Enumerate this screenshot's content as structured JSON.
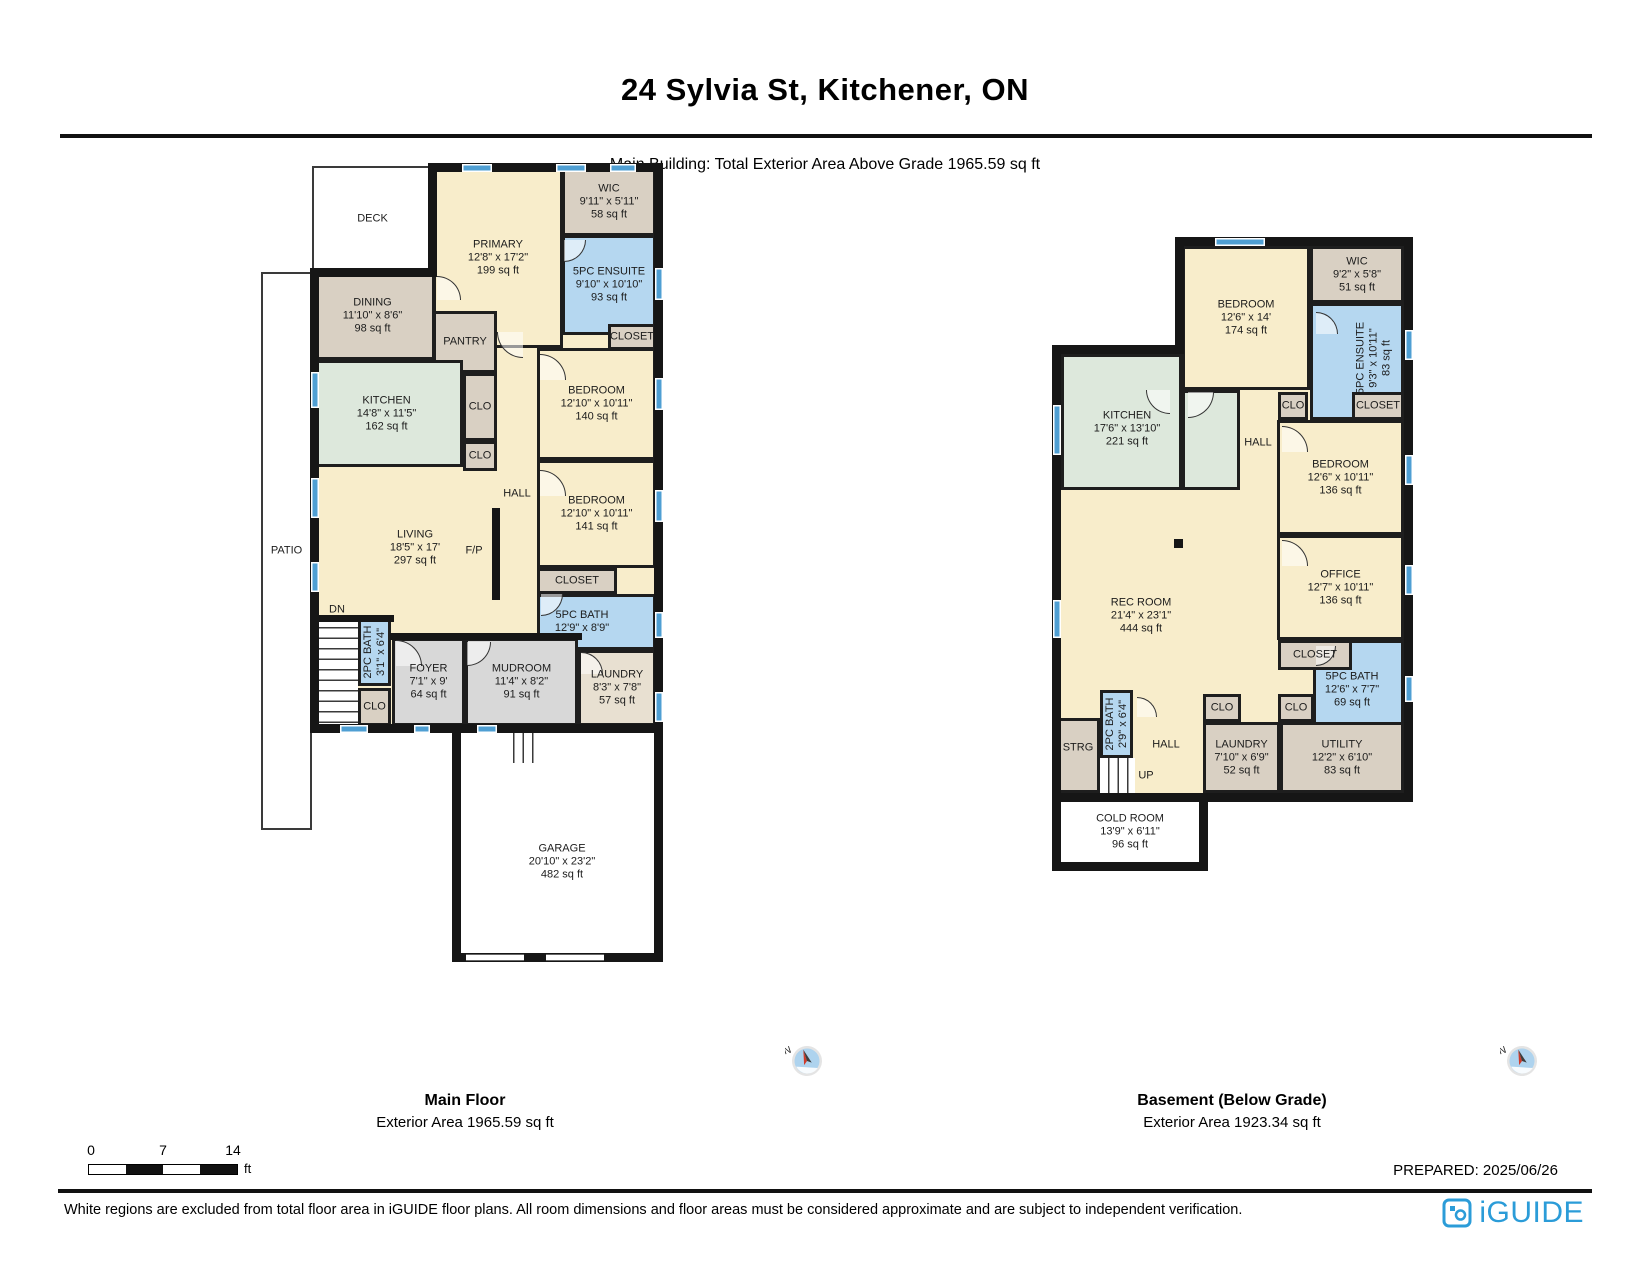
{
  "header": {
    "title": "24 Sylvia St, Kitchener, ON",
    "subtitle": "Main Building: Total Exterior Area Above Grade 1965.59 sq ft"
  },
  "compass": {
    "label": "N"
  },
  "scale_bar": {
    "ticks": [
      "0",
      "7",
      "14"
    ],
    "unit": "ft"
  },
  "footer": {
    "prepared": "PREPARED: 2025/06/26",
    "disclaimer": "White regions are excluded from total floor area in iGUIDE floor plans. All room dimensions and floor areas must be considered approximate and are subject to independent verification.",
    "brand": "iGUIDE"
  },
  "colors": {
    "room_cream": "#f8edcb",
    "room_tan": "#d9d0c3",
    "room_tan_light": "#e8e0d1",
    "room_blue": "#b5d7f0",
    "room_green": "#dde8dc",
    "room_gray": "#d8d8d8",
    "wall": "#161616",
    "window_blue": "#4f9fd3",
    "brand_blue": "#2b9cd8"
  },
  "floors": [
    {
      "id": "main",
      "name": "Main Floor",
      "area_label": "Exterior Area 1965.59 sq ft",
      "bg": [
        [
          314,
          168,
          345,
          560
        ]
      ],
      "rooms": [
        {
          "id": "deck",
          "rect": [
            312,
            166,
            121,
            105
          ],
          "fill": "white",
          "thin": true,
          "lines": [
            "DECK"
          ]
        },
        {
          "id": "patio",
          "rect": [
            261,
            272,
            51,
            558
          ],
          "fill": "white",
          "thin": true,
          "lines": [
            "PATIO"
          ]
        },
        {
          "id": "primary-bedroom",
          "rect": [
            433,
            168,
            130,
            180
          ],
          "fill": "cream",
          "lines": [
            "PRIMARY",
            "12'8\" x 17'2\"",
            "199 sq ft"
          ]
        },
        {
          "id": "wic",
          "rect": [
            562,
            168,
            94,
            68
          ],
          "fill": "tan",
          "lines": [
            "WIC",
            "9'11\" x 5'11\"",
            "58 sq ft"
          ]
        },
        {
          "id": "ensuite-5pc",
          "rect": [
            562,
            235,
            94,
            100
          ],
          "fill": "blue",
          "lines": [
            "5PC ENSUITE",
            "9'10\" x 10'10\"",
            "93 sq ft"
          ]
        },
        {
          "id": "closet-ensuite",
          "rect": [
            608,
            324,
            48,
            26
          ],
          "fill": "tan",
          "lines": [
            "CLOSET"
          ]
        },
        {
          "id": "dining",
          "rect": [
            310,
            271,
            125,
            89
          ],
          "fill": "tan",
          "lines": [
            "DINING",
            "11'10\" x 8'6\"",
            "98 sq ft"
          ]
        },
        {
          "id": "pantry",
          "rect": [
            433,
            311,
            64,
            62
          ],
          "fill": "tan",
          "lines": [
            "PANTRY"
          ]
        },
        {
          "id": "kitchen",
          "rect": [
            310,
            360,
            153,
            107
          ],
          "fill": "green",
          "lines": [
            "KITCHEN",
            "14'8\" x 11'5\"",
            "162 sq ft"
          ]
        },
        {
          "id": "closet-hall-a",
          "rect": [
            463,
            373,
            34,
            68
          ],
          "fill": "tan",
          "lines": [
            "CLO"
          ]
        },
        {
          "id": "closet-hall-b",
          "rect": [
            463,
            441,
            34,
            30
          ],
          "fill": "tan",
          "lines": [
            "CLO"
          ]
        },
        {
          "id": "bedroom-1",
          "rect": [
            537,
            348,
            119,
            112
          ],
          "fill": "cream",
          "lines": [
            "BEDROOM",
            "12'10\" x 10'11\"",
            "140 sq ft"
          ]
        },
        {
          "id": "bedroom-2",
          "rect": [
            537,
            460,
            119,
            108
          ],
          "fill": "cream",
          "lines": [
            "BEDROOM",
            "12'10\" x 10'11\"",
            "141 sq ft"
          ]
        },
        {
          "id": "closet-bedroom2",
          "rect": [
            537,
            568,
            80,
            26
          ],
          "fill": "tan",
          "lines": [
            "CLOSET"
          ]
        },
        {
          "id": "bath-5pc",
          "rect": [
            537,
            594,
            119,
            56
          ],
          "fill": "blue",
          "lx": 582,
          "lines": [
            "5PC BATH",
            "12'9\" x 8'9\""
          ]
        },
        {
          "id": "living",
          "lx": 415,
          "ly": 548,
          "lines": [
            "LIVING",
            "18'5\" x 17'",
            "297 sq ft"
          ]
        },
        {
          "id": "hall",
          "lx": 517,
          "ly": 494,
          "lines": [
            "HALL"
          ]
        },
        {
          "id": "fireplace-label",
          "lx": 474,
          "ly": 551,
          "lines": [
            "F/P"
          ]
        },
        {
          "id": "dn-label",
          "lx": 337,
          "ly": 610,
          "lines": [
            "DN"
          ]
        },
        {
          "id": "stairs-down",
          "rect": [
            312,
            618,
            46,
            107
          ],
          "fill": "white",
          "stairs": "h"
        },
        {
          "id": "bath-2pc",
          "rect": [
            358,
            618,
            33,
            68
          ],
          "fill": "blue",
          "vert": true,
          "lines": [
            "2PC BATH",
            "3'1\" x 6'4\""
          ]
        },
        {
          "id": "closet-foyer",
          "rect": [
            358,
            688,
            33,
            38
          ],
          "fill": "tan",
          "lines": [
            "CLO"
          ]
        },
        {
          "id": "foyer",
          "rect": [
            392,
            638,
            73,
            88
          ],
          "fill": "gray",
          "lines": [
            "FOYER",
            "7'1\" x 9'",
            "64 sq ft"
          ]
        },
        {
          "id": "mudroom",
          "rect": [
            465,
            638,
            113,
            88
          ],
          "fill": "gray",
          "lines": [
            "MUDROOM",
            "11'4\" x 8'2\"",
            "91 sq ft"
          ]
        },
        {
          "id": "laundry",
          "rect": [
            578,
            650,
            78,
            76
          ],
          "fill": "tan2",
          "lines": [
            "LAUNDRY",
            "8'3\" x 7'8\"",
            "57 sq ft"
          ]
        },
        {
          "id": "garage",
          "rect": [
            457,
            738,
            201,
            219
          ],
          "fill": "white",
          "nb": true,
          "lx": 562,
          "ly": 862,
          "lines": [
            "GARAGE",
            "20'10\" x 23'2\"",
            "482 sq ft"
          ]
        },
        {
          "id": "stairs-garage",
          "rect": [
            505,
            733,
            34,
            30
          ],
          "fill": "white",
          "stairs": "v"
        }
      ],
      "walls": [
        [
          430,
          163,
          233,
          9
        ],
        [
          654,
          163,
          9,
          570
        ],
        [
          310,
          724,
          353,
          9
        ],
        [
          310,
          268,
          9,
          465
        ],
        [
          310,
          268,
          125,
          9
        ],
        [
          428,
          163,
          9,
          114
        ],
        [
          452,
          733,
          9,
          229
        ],
        [
          654,
          733,
          9,
          229
        ],
        [
          452,
          953,
          211,
          9
        ],
        [
          310,
          615,
          84,
          7
        ],
        [
          390,
          633,
          192,
          7
        ],
        [
          492,
          508,
          8,
          92
        ]
      ],
      "windows": [
        [
          462,
          164,
          30,
          8
        ],
        [
          556,
          164,
          30,
          8
        ],
        [
          610,
          164,
          26,
          8
        ],
        [
          655,
          268,
          8,
          32
        ],
        [
          655,
          378,
          8,
          32
        ],
        [
          655,
          490,
          8,
          32
        ],
        [
          655,
          612,
          8,
          26
        ],
        [
          655,
          692,
          8,
          30
        ],
        [
          311,
          372,
          8,
          36
        ],
        [
          311,
          478,
          8,
          40
        ],
        [
          311,
          562,
          8,
          30
        ],
        [
          340,
          725,
          28,
          8
        ],
        [
          414,
          725,
          16,
          8
        ],
        [
          477,
          725,
          20,
          8
        ]
      ],
      "openings": [
        [
          466,
          954,
          58,
          7
        ],
        [
          546,
          954,
          58,
          7
        ]
      ],
      "doors": [
        [
          497,
          332,
          26,
          180
        ],
        [
          540,
          354,
          26,
          0
        ],
        [
          540,
          470,
          26,
          0
        ],
        [
          541,
          594,
          22,
          90
        ],
        [
          396,
          640,
          26,
          0
        ],
        [
          467,
          642,
          24,
          90
        ],
        [
          581,
          652,
          22,
          0
        ],
        [
          437,
          276,
          24,
          0
        ],
        [
          564,
          240,
          22,
          90
        ]
      ]
    },
    {
      "id": "basement",
      "name": "Basement (Below Grade)",
      "area_label": "Exterior Area 1923.34 sq ft",
      "bg": [
        [
          1182,
          245,
          222,
          552
        ],
        [
          1056,
          352,
          126,
          445
        ]
      ],
      "rooms": [
        {
          "id": "bedroom-basement-1",
          "rect": [
            1182,
            246,
            128,
            144
          ],
          "fill": "cream",
          "lines": [
            "BEDROOM",
            "12'6\" x 14'",
            "174 sq ft"
          ]
        },
        {
          "id": "wic-basement",
          "rect": [
            1310,
            246,
            94,
            57
          ],
          "fill": "tan",
          "lines": [
            "WIC",
            "9'2\" x 5'8\"",
            "51 sq ft"
          ]
        },
        {
          "id": "ensuite-basement",
          "rect": [
            1310,
            303,
            94,
            117
          ],
          "fill": "blue",
          "vert": true,
          "lx": 1374,
          "ly": 358,
          "lines": [
            "5PC ENSUITE",
            "9'3\" x 10'11\"",
            "83 sq ft"
          ]
        },
        {
          "id": "closet-hall-basement",
          "rect": [
            1278,
            392,
            30,
            28
          ],
          "fill": "tan",
          "lines": [
            "CLO"
          ]
        },
        {
          "id": "closet-upper-basement",
          "rect": [
            1352,
            392,
            52,
            28
          ],
          "fill": "tan",
          "lines": [
            "CLOSET"
          ]
        },
        {
          "id": "bedroom-basement-2",
          "rect": [
            1277,
            420,
            127,
            115
          ],
          "fill": "cream",
          "lines": [
            "BEDROOM",
            "12'6\" x 10'11\"",
            "136 sq ft"
          ]
        },
        {
          "id": "office",
          "rect": [
            1277,
            535,
            127,
            105
          ],
          "fill": "cream",
          "lines": [
            "OFFICE",
            "12'7\" x 10'11\"",
            "136 sq ft"
          ]
        },
        {
          "id": "bath-5pc-basement",
          "rect": [
            1313,
            640,
            91,
            85
          ],
          "fill": "blue",
          "lx": 1352,
          "ly": 690,
          "lines": [
            "5PC BATH",
            "12'6\" x 7'7\"",
            "69 sq ft"
          ]
        },
        {
          "id": "closet-office",
          "rect": [
            1278,
            640,
            74,
            30
          ],
          "fill": "tan",
          "lines": [
            "CLOSET"
          ]
        },
        {
          "id": "kitchen-basement",
          "rect": [
            1061,
            354,
            121,
            136
          ],
          "fill": "green",
          "lx": 1127,
          "ly": 429,
          "lines": [
            "KITCHEN",
            "17'6\" x 13'10\"",
            "221 sq ft"
          ]
        },
        {
          "id": "kitchen-basement-ext",
          "rect": [
            1182,
            390,
            58,
            100
          ],
          "fill": "green"
        },
        {
          "id": "rec-room",
          "lx": 1141,
          "ly": 616,
          "lines": [
            "REC ROOM",
            "21'4\" x 23'1\"",
            "444 sq ft"
          ]
        },
        {
          "id": "hall-basement-upper",
          "lx": 1258,
          "ly": 443,
          "lines": [
            "HALL"
          ]
        },
        {
          "id": "hall-basement-lower",
          "lx": 1166,
          "ly": 745,
          "lines": [
            "HALL"
          ]
        },
        {
          "id": "up-label",
          "lx": 1146,
          "ly": 776,
          "lines": [
            "UP"
          ]
        },
        {
          "id": "closet-rec-1",
          "rect": [
            1203,
            694,
            38,
            28
          ],
          "fill": "tan",
          "lines": [
            "CLO"
          ]
        },
        {
          "id": "closet-rec-2",
          "rect": [
            1278,
            694,
            36,
            28
          ],
          "fill": "tan",
          "lines": [
            "CLO"
          ]
        },
        {
          "id": "laundry-basement",
          "rect": [
            1203,
            722,
            77,
            71
          ],
          "fill": "tan",
          "lines": [
            "LAUNDRY",
            "7'10\" x 6'9\"",
            "52 sq ft"
          ]
        },
        {
          "id": "utility",
          "rect": [
            1280,
            722,
            124,
            71
          ],
          "fill": "tan",
          "lines": [
            "UTILITY",
            "12'2\" x 6'10\"",
            "83 sq ft"
          ]
        },
        {
          "id": "storage",
          "rect": [
            1056,
            718,
            44,
            75
          ],
          "fill": "tan",
          "lx": 1078,
          "ly": 748,
          "lines": [
            "STRG"
          ]
        },
        {
          "id": "bath-2pc-basement",
          "rect": [
            1100,
            690,
            33,
            68
          ],
          "fill": "blue",
          "vert": true,
          "lines": [
            "2PC BATH",
            "2'9\" x 6'4\""
          ]
        },
        {
          "id": "stairs-up",
          "rect": [
            1100,
            758,
            35,
            35
          ],
          "fill": "white",
          "stairs": "v"
        },
        {
          "id": "cold-room",
          "rect": [
            1058,
            799,
            144,
            66
          ],
          "fill": "white",
          "nb": true,
          "lines": [
            "COLD ROOM",
            "13'9\" x 6'11\"",
            "96 sq ft"
          ]
        }
      ],
      "walls": [
        [
          1175,
          237,
          238,
          9
        ],
        [
          1404,
          237,
          9,
          565
        ],
        [
          1052,
          793,
          361,
          9
        ],
        [
          1052,
          345,
          9,
          457
        ],
        [
          1052,
          345,
          131,
          9
        ],
        [
          1175,
          237,
          9,
          117
        ],
        [
          1052,
          802,
          9,
          69
        ],
        [
          1052,
          862,
          156,
          9
        ],
        [
          1199,
          802,
          9,
          69
        ],
        [
          1174,
          539,
          9,
          9
        ]
      ],
      "windows": [
        [
          1215,
          238,
          50,
          8
        ],
        [
          1053,
          405,
          8,
          50
        ],
        [
          1053,
          600,
          8,
          38
        ],
        [
          1405,
          330,
          8,
          30
        ],
        [
          1405,
          455,
          8,
          30
        ],
        [
          1405,
          565,
          8,
          30
        ],
        [
          1405,
          676,
          8,
          26
        ]
      ],
      "doors": [
        [
          1188,
          392,
          26,
          90
        ],
        [
          1282,
          426,
          26,
          0
        ],
        [
          1282,
          540,
          26,
          0
        ],
        [
          1316,
          646,
          20,
          90
        ],
        [
          1137,
          697,
          20,
          0
        ],
        [
          1316,
          312,
          22,
          0
        ],
        [
          1146,
          390,
          24,
          180
        ]
      ]
    }
  ]
}
